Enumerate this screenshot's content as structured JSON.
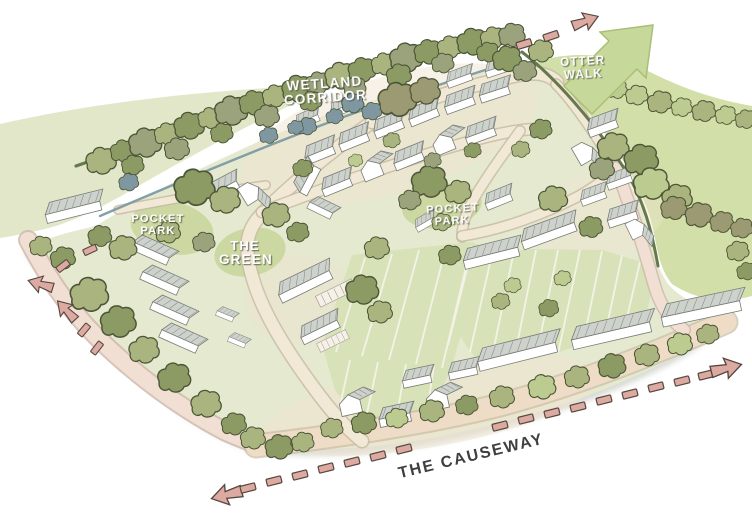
{
  "labels": {
    "wetland": {
      "l1": "WETLAND",
      "l2": "CORRIDOR"
    },
    "otter": {
      "l1": "OTTER",
      "l2": "WALK"
    },
    "pocket_west": {
      "l1": "POCKET",
      "l2": "PARK"
    },
    "pocket_central": {
      "l1": "POCKET",
      "l2": "PARK"
    },
    "green": {
      "l1": "THE",
      "l2": "GREEN"
    },
    "causeway": "THE CAUSEWAY"
  },
  "icons": {
    "otter-walk-arrow": "large green flow arrow pointing north-east",
    "route-dash": "pink dashed pedestrian/vehicle route marker",
    "route-arrowhead": "pink block arrowhead"
  },
  "colors": {
    "bg": "#ffffff",
    "field-left": "#e2e7c9",
    "field-right": "#d2dfa8",
    "site-green": "#e4e9cf",
    "strips-green": "#d8e2b8",
    "patch-green": "#cbd8a2",
    "ground-tan": "#efe3d0",
    "road-fill": "#f1e8d6",
    "road-edge": "#c8bca3",
    "path-pink": "#f2dfd4",
    "path-pink-edge": "#cdb6a9",
    "band-tan": "#eedcc7",
    "tree-mid": "#a9b47e",
    "tree-dark": "#8c9a63",
    "tree-gray": "#9aa37c",
    "tree-light": "#bccb90",
    "tree-brown": "#9c9a72",
    "tree-blue": "#7e97a0",
    "outline": "#4c5537",
    "hedge": "#66794c",
    "stream": "#7796a1",
    "roof-light": "#ced2cd",
    "roof-dark": "#b7bcb7",
    "roof-line": "#878c86",
    "house-wall": "#ffffff",
    "arrow-green": "#c6d89a",
    "arrow-green-edge": "#a9bf76",
    "dash-pink": "#dcaaa1",
    "dash-outline": "#564840",
    "label-dark": "#3f3f3f",
    "shadow": "#a7aca0"
  }
}
